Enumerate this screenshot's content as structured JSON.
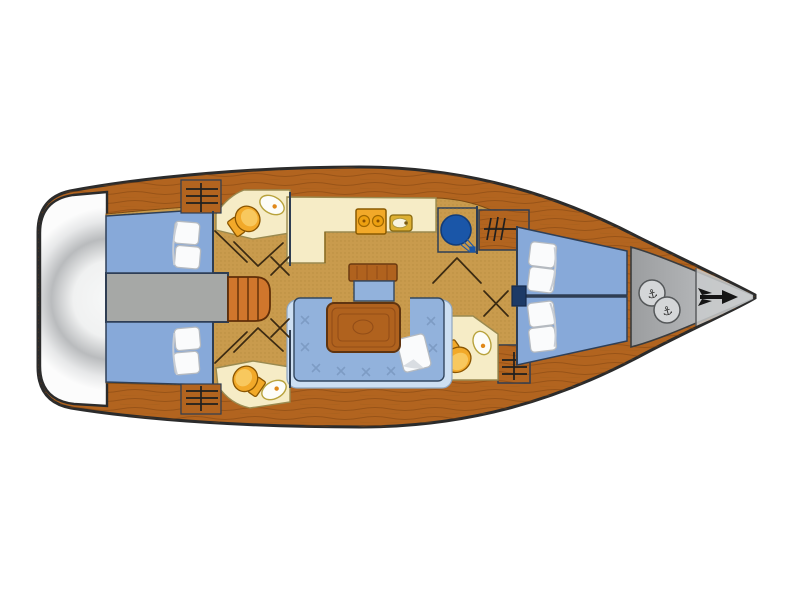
{
  "diagram": {
    "type": "yacht-floor-plan",
    "description": "Top-view interior layout plan of a sailing yacht, bow pointing right",
    "orientation": "bow-right"
  },
  "colors": {
    "background": "#ffffff",
    "hull_outline": "#2b2b2b",
    "deck_wood": "#b2641f",
    "wood_grain": "#7e4210",
    "floor_tan": "#c99b4d",
    "floor_dot": "#a87f33",
    "berth_blue": "#87a9d9",
    "settee_blue": "#92b2dc",
    "settee_trim": "#cddff2",
    "bulkhead_navy": "#2e3d52",
    "cream": "#f6ecc6",
    "fixture_orange": "#f2a929",
    "corridor_gray": "#a6a8a6",
    "bow_gray": "#a9abad",
    "stern_gray": "#b9bbbd",
    "nav_seat_blue": "#1a56a8",
    "steps_orange": "#d0762c",
    "table_wood": "#b0621e",
    "pillow_white": "#fafbfc"
  },
  "areas": {
    "stern": {
      "label": "Stern swim platform"
    },
    "aft_cabin_top": {
      "label": "Aft double cabin (port)",
      "features": "double berth, two pillows, wardrobe"
    },
    "aft_cabin_bottom": {
      "label": "Aft double cabin (starboard)",
      "features": "double berth, two pillows, wardrobe"
    },
    "corridor": {
      "label": "Cockpit corridor with companionway steps"
    },
    "aft_head_top": {
      "label": "Aft head (port)",
      "features": "toilet, washbasin"
    },
    "aft_head_bottom": {
      "label": "Aft head (starboard)",
      "features": "toilet, washbasin"
    },
    "galley": {
      "label": "Galley",
      "features": "two-burner stove, sink, counter"
    },
    "salon": {
      "label": "Salon",
      "features": "U-shaped settee, wood table, bench seat, cushion"
    },
    "nav": {
      "label": "Navigation station",
      "features": "chart table, round navigator seat"
    },
    "fwd_head": {
      "label": "Forward head",
      "features": "toilet, washbasin, wardrobe"
    },
    "fwd_cabin": {
      "label": "Forward V-berth cabin",
      "features": "two single berths, pillows, wardrobes"
    },
    "bow": {
      "label": "Bow anchor locker",
      "features": "two windlass hatches, anchor"
    }
  },
  "icons": {
    "windlass_anchor": "anchor-icon",
    "bow_anchor": "anchor-arrow-icon",
    "wardrobe": "hanging-locker-icon",
    "door_swing": "door-swing-line"
  }
}
